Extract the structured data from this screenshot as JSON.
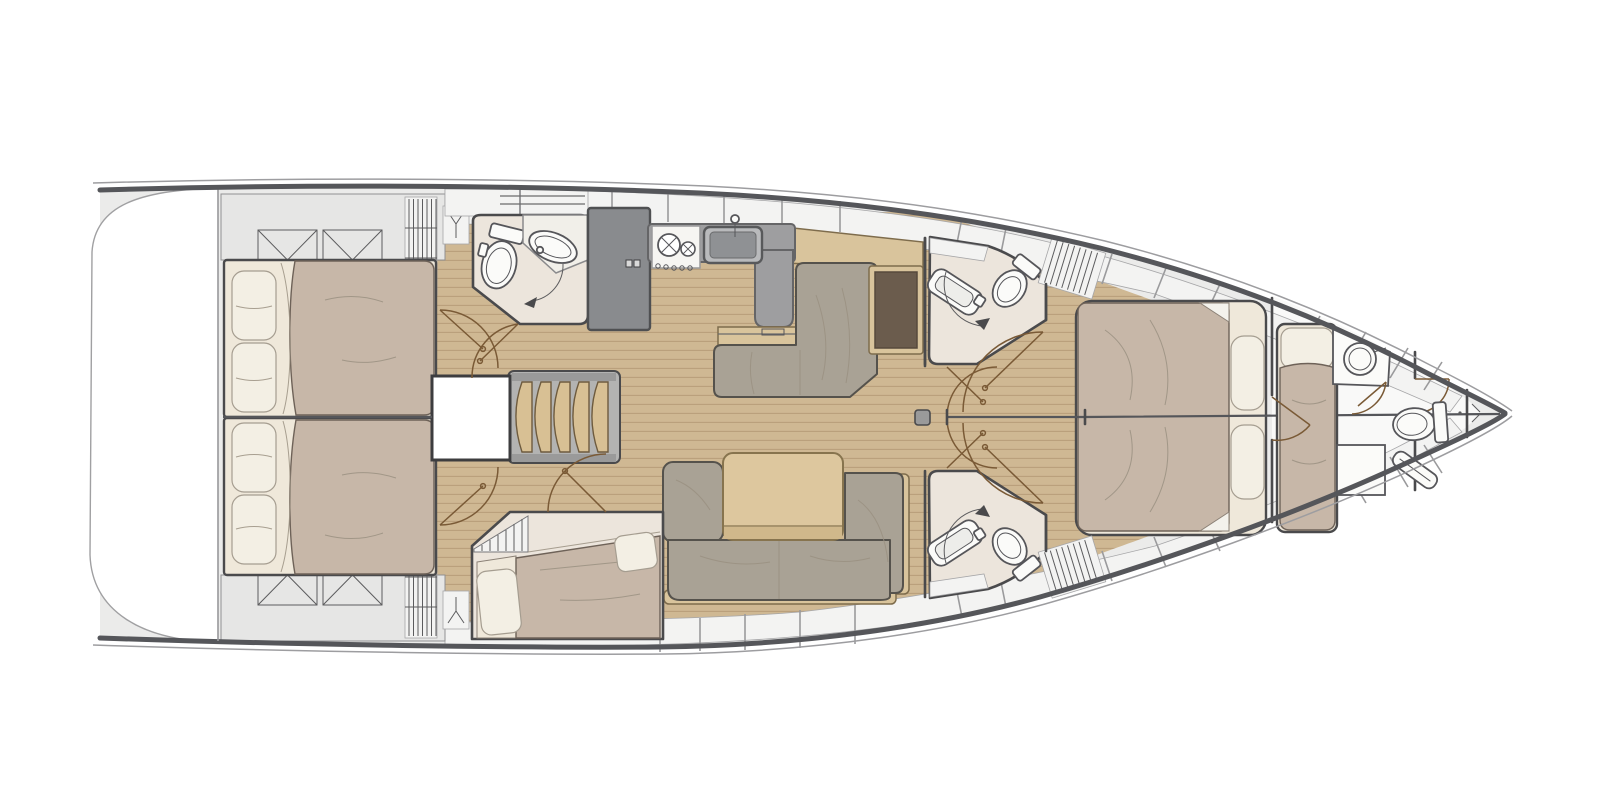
{
  "diagram": {
    "type": "yacht-floor-plan",
    "description": "Top-down interior layout plan of a sailing yacht: swim platform aft, two aft double cabins, aft head, galley, salon with L-sofa, chart table, dining table and U-settee, two mid heads, forward owner cabin with island berth, bow crew cabin with washbasin and fore head with toilet and shower, anchor locker at bow tip.",
    "orientation": "bow-right"
  },
  "rooms": [
    {
      "id": "swim-platform",
      "label": "Swim platform / transom"
    },
    {
      "id": "cockpit-lockers",
      "label": "Cockpit stowage with crossed-hatch lockers"
    },
    {
      "id": "aft-cabin-starboard",
      "label": "Aft double cabin (top)"
    },
    {
      "id": "aft-cabin-port",
      "label": "Aft double cabin (bottom)"
    },
    {
      "id": "aft-head",
      "label": "Aft head with toilet and washbasin"
    },
    {
      "id": "bunk-cabin",
      "label": "Third cabin with double berth (bottom)"
    },
    {
      "id": "companionway",
      "label": "Companionway steps and engine box"
    },
    {
      "id": "galley",
      "label": "Galley: refrigerator, two-burner stove, sink"
    },
    {
      "id": "salon",
      "label": "Salon: L-sofa, chart table, dining table, U-settee, mast step"
    },
    {
      "id": "mid-head-starboard",
      "label": "Mid head (top) with toilet and basin"
    },
    {
      "id": "mid-head-port",
      "label": "Mid head (bottom) with toilet and basin"
    },
    {
      "id": "owner-cabin",
      "label": "Forward owner cabin with island double berth"
    },
    {
      "id": "bow-cabin",
      "label": "Bow crew cabin with single berth and washbasin"
    },
    {
      "id": "fore-head",
      "label": "Fore head with toilet and shower"
    },
    {
      "id": "anchor-locker",
      "label": "Anchor locker at bow tip"
    }
  ],
  "icons": [
    {
      "id": "crossed-locker-icon",
      "meaning": "deck locker hatch (rectangle with V cross)"
    },
    {
      "id": "louver-icon",
      "meaning": "louvered locker / vent (parallel lines)"
    },
    {
      "id": "hanging-locker-icon",
      "meaning": "wardrobe with hanger symbol"
    },
    {
      "id": "door-swing-arc",
      "meaning": "door opening direction arc"
    },
    {
      "id": "mast-step-icon",
      "meaning": "mast position square"
    }
  ],
  "colors": {
    "deck": "#ebebea",
    "platform": "#ffffff",
    "bowFloor": "#f9f9f8",
    "panel": "#f3f3f2",
    "cockpit": "#e6e6e5",
    "wood": "#cfb893",
    "woodline": "#b79d79",
    "wall": "#4a4a4c",
    "hull": "#55565a",
    "headFloor": "#ece5dc",
    "counter": "#9e9ea0",
    "fridge": "#898b8e",
    "sofa": "#a9a295",
    "duvet": "#c7b7a8",
    "sheet": "#efe8da",
    "pillow": "#f3efe4",
    "tan": "#d9c49c",
    "chart": "#6b5c4d",
    "door": "#7a5a36",
    "steps": "#d8c094"
  }
}
